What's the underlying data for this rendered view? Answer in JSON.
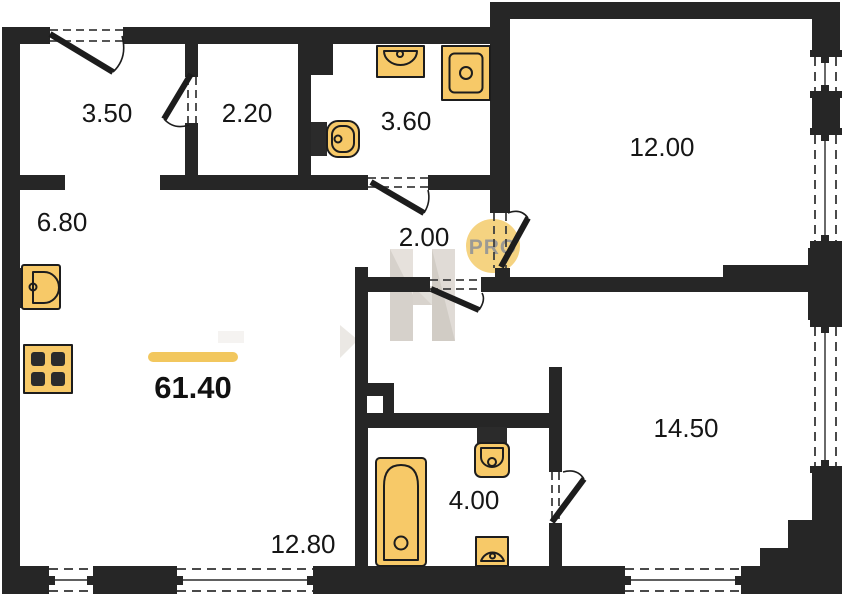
{
  "plan": {
    "total": {
      "area": "61.40"
    },
    "rooms": {
      "entry_hall": {
        "area": "3.50"
      },
      "wardrobe": {
        "area": "2.20"
      },
      "shower_room": {
        "area": "3.60"
      },
      "bedroom_top": {
        "area": "12.00"
      },
      "kitchen": {
        "area": "6.80"
      },
      "hallway": {
        "area": "2.00"
      },
      "living_room": {
        "area": "12.80"
      },
      "bathroom": {
        "area": "4.00"
      },
      "bedroom_bottom": {
        "area": "14.50"
      }
    },
    "watermark": {
      "text": "PRO"
    },
    "fixtures": {
      "kitchen_sink": "kitchen-sink-icon",
      "stove": "stove-icon",
      "washbasin_small": "washbasin-icon",
      "shower": "shower-tray-icon",
      "toilet_small": "toilet-icon",
      "bathtub": "bathtub-icon",
      "toilet_main": "toilet-icon",
      "washbasin_main": "washbasin-icon"
    },
    "colors": {
      "wall": "#262626",
      "fixture_fill": "#f7c968",
      "fixture_stroke": "#1d1d1d",
      "accent_bar": "#f2c75e",
      "watermark_circle": "#f2c65f",
      "watermark_text": "#8f8d86",
      "label_text": "#161616"
    }
  }
}
